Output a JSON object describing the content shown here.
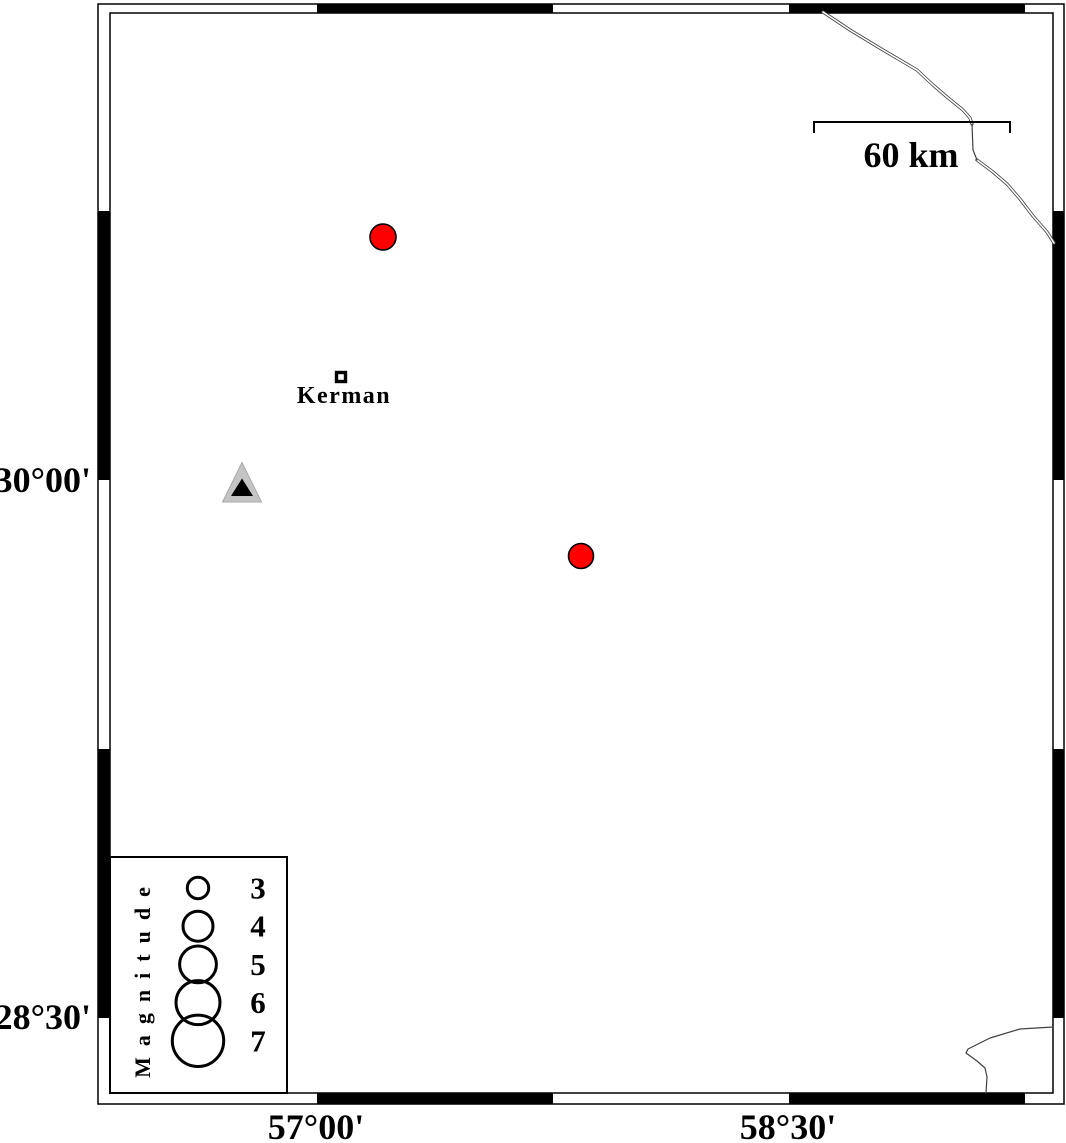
{
  "figure": {
    "kind": "seismicity-map",
    "background_color": "#ffffff",
    "ink_color": "#000000",
    "boundary_line_color": "#3f3f3f",
    "earthquake_color": "#ff0000",
    "station_fill_color": "#c4c4c4"
  },
  "axis": {
    "left_labels": [
      {
        "text": "30°00'",
        "x": 91,
        "y": 492
      },
      {
        "text": "28°30'",
        "x": 91,
        "y": 1029
      }
    ],
    "bottom_labels": [
      {
        "text": "57°00'",
        "x": 316,
        "y": 1139
      },
      {
        "text": "58°30'",
        "x": 788,
        "y": 1139
      }
    ]
  },
  "frame": {
    "outer": {
      "x1": 98,
      "y1": 4,
      "x2": 1064,
      "y2": 1104
    },
    "inner": {
      "x1": 110,
      "y1": 13,
      "x2": 1053,
      "y2": 1093
    },
    "x_black_segments": [
      [
        317,
        553
      ],
      [
        789,
        1025
      ]
    ],
    "y_black_segments": [
      [
        211,
        480
      ],
      [
        749,
        1018
      ]
    ]
  },
  "scale_bar": {
    "label": "60 km",
    "x1": 814,
    "x2": 1010,
    "y": 122,
    "tick_len": 11,
    "label_x": 911,
    "label_y": 167
  },
  "markers": {
    "earthquakes": [
      {
        "cx": 383,
        "cy": 237,
        "r": 13
      },
      {
        "cx": 581,
        "cy": 556,
        "r": 12.5
      }
    ],
    "station": {
      "outer_triangle": [
        [
          242,
          462.5
        ],
        [
          222.5,
          502
        ],
        [
          261.5,
          502
        ]
      ],
      "inner_triangle": [
        [
          242,
          478.5
        ],
        [
          231,
          496
        ],
        [
          253,
          496
        ]
      ]
    },
    "city": {
      "label": "Kerman",
      "cx": 341,
      "cy": 377,
      "size": 9,
      "label_x": 344,
      "label_y": 403
    }
  },
  "lines": {
    "ne_double_a": [
      [
        823,
        12
      ],
      [
        850,
        30
      ],
      [
        883,
        50
      ],
      [
        917,
        70
      ],
      [
        933,
        85
      ],
      [
        947,
        97
      ],
      [
        963,
        110
      ],
      [
        970,
        118
      ],
      [
        972,
        124
      ]
    ],
    "ne_single": [
      [
        972,
        124
      ],
      [
        973,
        150
      ],
      [
        977,
        160
      ]
    ],
    "ne_double_b": [
      [
        977,
        160
      ],
      [
        993,
        172
      ],
      [
        1007,
        184
      ],
      [
        1020,
        199
      ],
      [
        1033,
        216
      ],
      [
        1047,
        232
      ],
      [
        1054,
        243
      ]
    ],
    "se_hook": [
      [
        1053,
        1027
      ],
      [
        1020,
        1029
      ],
      [
        990,
        1038
      ],
      [
        968,
        1049
      ],
      [
        966,
        1053
      ],
      [
        977,
        1061
      ],
      [
        985,
        1068
      ],
      [
        987,
        1077
      ],
      [
        986,
        1093
      ]
    ]
  },
  "legend": {
    "title": "Magnitude",
    "box": {
      "x": 110,
      "y": 857,
      "w": 177,
      "h": 236
    },
    "title_x": 150,
    "title_y": 977,
    "circle_cx": 198,
    "first_cy": 888,
    "dy": 38.2,
    "label_x": 258,
    "entries": [
      {
        "label": "3",
        "r": 10.7
      },
      {
        "label": "4",
        "r": 15
      },
      {
        "label": "5",
        "r": 18.4
      },
      {
        "label": "6",
        "r": 22
      },
      {
        "label": "7",
        "r": 25.7
      }
    ]
  }
}
